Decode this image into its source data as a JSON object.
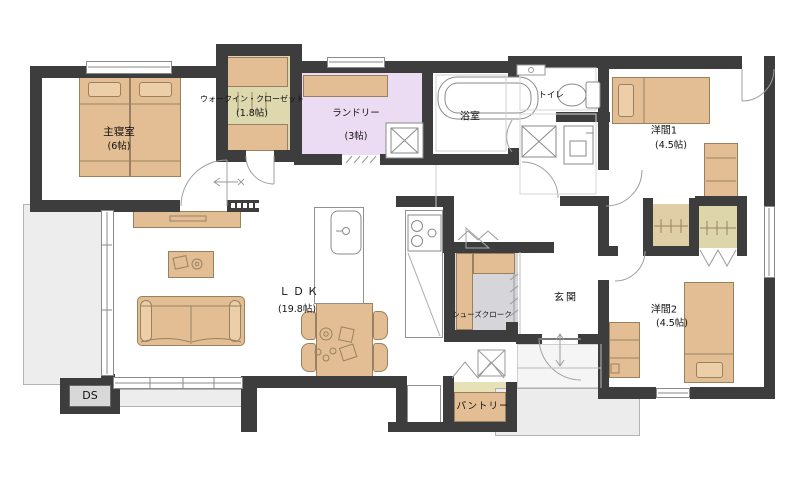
{
  "labels": {
    "master_bedroom": {
      "name": "主寝室",
      "size": "(6帖)"
    },
    "walk_in_closet": {
      "name": "ウォークイン・クローゼット",
      "size": "(1.8帖)"
    },
    "laundry": {
      "name": "ランドリー",
      "size": "(3帖)"
    },
    "bathroom": {
      "name": "浴室"
    },
    "toilet": {
      "name": "トイレ"
    },
    "western_room_1": {
      "name": "洋間1",
      "size": "(4.5帖)"
    },
    "western_room_2": {
      "name": "洋間2",
      "size": "(4.5帖)"
    },
    "ldk": {
      "name": "ＬＤＫ",
      "size": "(19.8帖)"
    },
    "shoes_closet": {
      "name": "シューズクローク"
    },
    "entrance": {
      "name": "玄関"
    },
    "pantry": {
      "name": "パントリー"
    },
    "duct_space": {
      "name": "DS"
    }
  },
  "colors": {
    "wall": "#3d3d3d",
    "furniture": "#e3bd94",
    "furniture_outline": "#99805f",
    "wic_floor": "#ded8ae",
    "laundry_floor": "#ecdcf3",
    "shoes_closet_floor": "#d6d6da",
    "pantry_floor": "#e7e1b8",
    "closet_floor": "#ddd6ab",
    "terrace_gray": "#ededed",
    "line_gray": "#8f8f8f"
  }
}
